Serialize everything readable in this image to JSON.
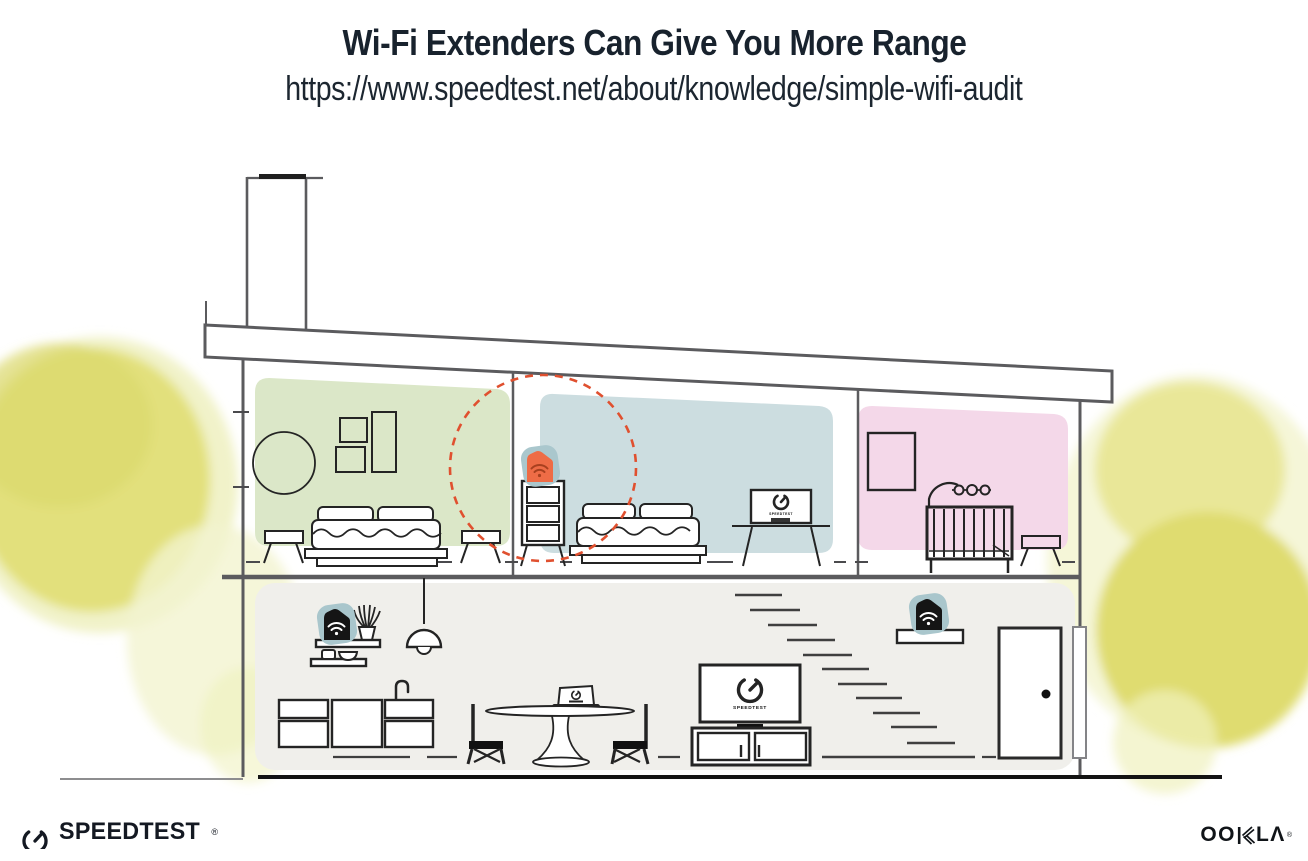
{
  "header": {
    "title": "Wi-Fi Extenders Can Give You More Range",
    "url": "https://www.speedtest.net/about/knowledge/simple-wifi-audit"
  },
  "scene": {
    "tv_living_label": "SPEEDTEST",
    "tv_bedroom_label": "SPEEDTEST",
    "icons": {
      "extender_upstairs": "wifi-extender-icon",
      "router_downstairs_left": "wifi-router-icon",
      "extender_downstairs_right": "wifi-extender-icon",
      "wifi_signal": "wifi-signal-arcs",
      "speedtest_gauge": "gauge-circle-with-needle"
    },
    "colors": {
      "extender_orange": "#ee6c46",
      "extender_wifi_dark": "#a8401f",
      "device_black": "#1a1a1a",
      "device_halo_teal": "#a9c6cc",
      "range_circle_red": "#e0502f",
      "bedroom_green": "#dbe7c8",
      "bedroom_blue": "#ccdde0",
      "nursery_pink": "#f4d8e9",
      "downstairs_gray": "#f0efeb",
      "foliage_yellow": "#e2e07b",
      "structure_gray": "#5b5b5e",
      "text_dark": "#18222d"
    }
  },
  "footer": {
    "speedtest_wordmark": "SPEEDTEST",
    "speedtest_reg": "®",
    "ookla_full": "OOKLA",
    "ookla_left": "OO",
    "ookla_right": "LΛ",
    "ookla_reg": "®"
  }
}
